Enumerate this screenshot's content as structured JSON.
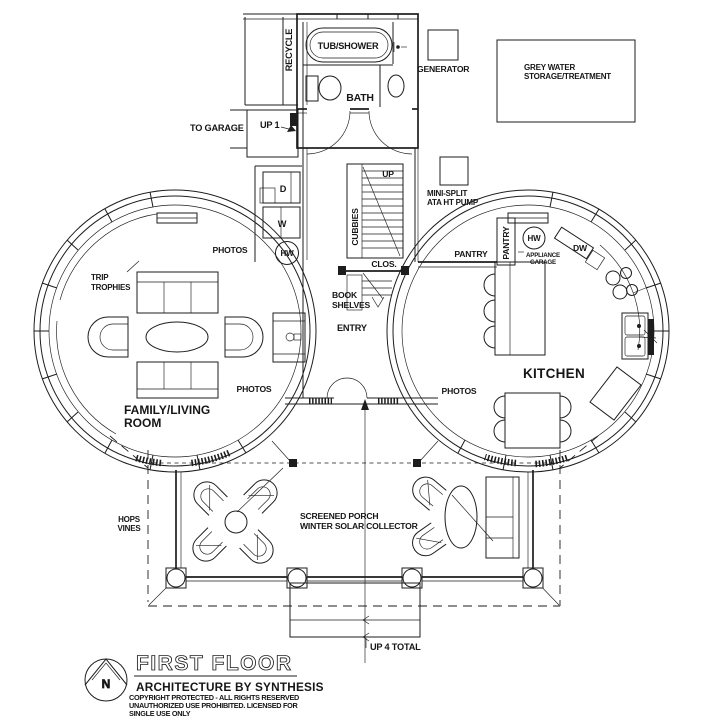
{
  "page": {
    "background": "#ffffff",
    "ink": "#1d1d1d"
  },
  "title_block": {
    "north": "N",
    "title": "FIRST FLOOR",
    "firm": "ARCHITECTURE BY SYNTHESIS",
    "copyright": [
      "COPYRIGHT PROTECTED - ALL RIGHTS RESERVED",
      "UNAUTHORIZED USE PROHIBITED. LICENSED FOR",
      "SINGLE USE ONLY"
    ]
  },
  "rooms": {
    "bath": "BATH",
    "entry": "ENTRY",
    "kitchen": "KITCHEN",
    "family_living": [
      "FAMILY/LIVING",
      "ROOM"
    ],
    "porch": [
      "SCREENED PORCH",
      "WINTER SOLAR COLLECTOR"
    ]
  },
  "fixtures": {
    "recycle": "RECYCLE",
    "tub_shower": "TUB/SHOWER",
    "generator": "GENERATOR",
    "grey_water": [
      "GREY WATER",
      "STORAGE/TREATMENT"
    ],
    "mini_split": [
      "MINI-SPLIT",
      "ATA HT PUMP"
    ],
    "dryer": "D",
    "washer": "W",
    "hw_laundry": "HW",
    "hw_kitchen": "HW",
    "cubbies": "CUBBIES",
    "closet": "CLOS.",
    "book_shelves": [
      "BOOK",
      "SHELVES"
    ],
    "pantry_wall": "PANTRY",
    "pantry_cabinet": "PANTRY",
    "appliance_garage": [
      "APPLIANCE",
      "GARAGE"
    ],
    "dishwasher": "DW",
    "photos_nw": "PHOTOS",
    "photos_sw": "PHOTOS",
    "photos_kitchen": "PHOTOS",
    "trip_trophies": [
      "TRIP",
      "TROPHIES"
    ],
    "hops_vines": [
      "HOPS",
      "VINES"
    ]
  },
  "annotations": {
    "to_garage": "TO GARAGE",
    "up_1": "UP 1",
    "up": "UP",
    "up_4_total": "UP 4 TOTAL"
  }
}
